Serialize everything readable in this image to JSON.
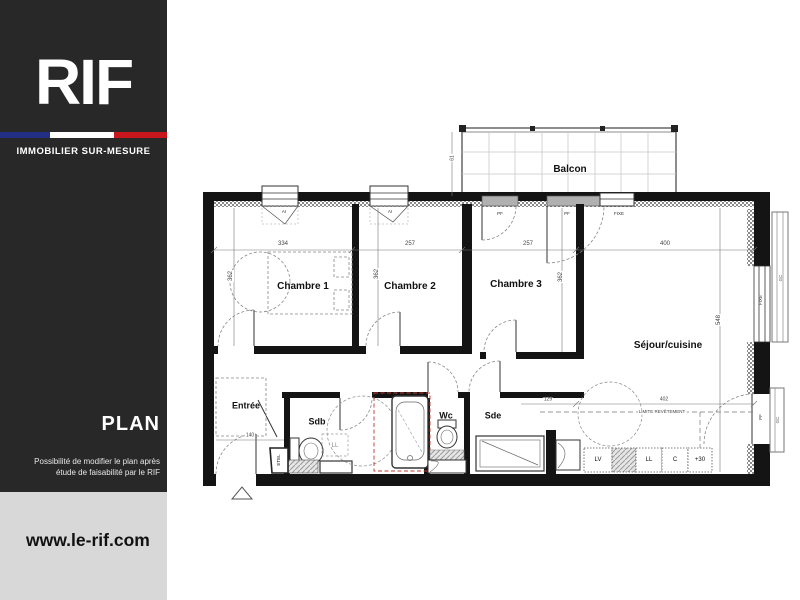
{
  "sidebar": {
    "brand": "RIF",
    "tagline": "IMMOBILIER  SUR-MESURE",
    "section_title": "PLAN",
    "note_line1": "Possibilité de modifier le plan après",
    "note_line2": "étude de faisabilité par le RIF",
    "website": "www.le-rif.com",
    "colors": {
      "sidebar_bg": "#282828",
      "flag_blue": "#232e85",
      "flag_white": "#ffffff",
      "flag_red": "#c8161d",
      "footer_bg": "#d8d8d8"
    }
  },
  "plan": {
    "labels": [
      {
        "id": "room-label-balcon",
        "text": "Balcon",
        "x": 570,
        "y": 170,
        "size": 10,
        "bold": true
      },
      {
        "id": "room-label-chambre-1",
        "text": "Chambre 1",
        "x": 303,
        "y": 287,
        "size": 10,
        "bold": true
      },
      {
        "id": "room-label-chambre-2",
        "text": "Chambre 2",
        "x": 410,
        "y": 287,
        "size": 10,
        "bold": true
      },
      {
        "id": "room-label-chambre-3",
        "text": "Chambre 3",
        "x": 516,
        "y": 285,
        "size": 10,
        "bold": true
      },
      {
        "id": "room-label-sejour-cuisine",
        "text": "Séjour/cuisine",
        "x": 668,
        "y": 346,
        "size": 10,
        "bold": true
      },
      {
        "id": "room-label-entree",
        "text": "Entrée",
        "x": 246,
        "y": 406,
        "size": 9,
        "bold": true
      },
      {
        "id": "room-label-sdb",
        "text": "Sdb",
        "x": 317,
        "y": 422,
        "size": 9,
        "bold": true
      },
      {
        "id": "room-label-wc",
        "text": "Wc",
        "x": 446,
        "y": 416,
        "size": 9,
        "bold": true
      },
      {
        "id": "room-label-sde",
        "text": "Sde",
        "x": 493,
        "y": 416,
        "size": 9,
        "bold": true
      },
      {
        "id": "dim-334",
        "text": "334",
        "x": 283,
        "y": 244,
        "size": 6,
        "bg": true,
        "color": "#444"
      },
      {
        "id": "dim-257-ch2",
        "text": "257",
        "x": 410,
        "y": 244,
        "size": 6,
        "bg": true,
        "color": "#444"
      },
      {
        "id": "dim-257-ch3",
        "text": "257",
        "x": 528,
        "y": 244,
        "size": 6,
        "bg": true,
        "color": "#444"
      },
      {
        "id": "dim-400",
        "text": "400",
        "x": 665,
        "y": 244,
        "size": 6,
        "bg": true,
        "color": "#444"
      },
      {
        "id": "dim-362-ch1",
        "text": "362",
        "x": 231,
        "y": 276,
        "size": 6,
        "rot": -90,
        "bg": true,
        "color": "#444"
      },
      {
        "id": "dim-362-ch2",
        "text": "362",
        "x": 377,
        "y": 274,
        "size": 6,
        "rot": -90,
        "bg": true,
        "color": "#444"
      },
      {
        "id": "dim-362-ch3",
        "text": "362",
        "x": 561,
        "y": 277,
        "size": 6,
        "rot": -90,
        "bg": true,
        "color": "#444"
      },
      {
        "id": "dim-548",
        "text": "548",
        "x": 719,
        "y": 320,
        "size": 6,
        "rot": -90,
        "bg": true,
        "color": "#444"
      },
      {
        "id": "dim-61",
        "text": "61",
        "x": 453,
        "y": 158,
        "size": 5,
        "rot": -90,
        "bg": true,
        "color": "#444"
      },
      {
        "id": "dim-140",
        "text": "140",
        "x": 250,
        "y": 436,
        "size": 5,
        "bg": true,
        "color": "#444"
      },
      {
        "id": "dim-129",
        "text": "129",
        "x": 548,
        "y": 400,
        "size": 5,
        "bg": true,
        "color": "#444"
      },
      {
        "id": "dim-402",
        "text": "402",
        "x": 664,
        "y": 400,
        "size": 5,
        "bg": true,
        "color": "#444"
      },
      {
        "id": "anno-limite-revetement",
        "text": "LIMITE REVÊTEMENT",
        "x": 662,
        "y": 412,
        "size": 4.5,
        "bg": true,
        "color": "#444"
      },
      {
        "id": "anno-lv",
        "text": "LV",
        "x": 598,
        "y": 460,
        "size": 6
      },
      {
        "id": "anno-ll-kitchen",
        "text": "LL",
        "x": 649,
        "y": 460,
        "size": 6
      },
      {
        "id": "anno-c",
        "text": "C",
        "x": 675,
        "y": 460,
        "size": 6
      },
      {
        "id": "anno-plus30",
        "text": "+30",
        "x": 700,
        "y": 460,
        "size": 6
      },
      {
        "id": "anno-ll-sdb",
        "text": "LL",
        "x": 335,
        "y": 446,
        "size": 6,
        "color": "#888"
      },
      {
        "id": "anno-etel",
        "text": "ETEL",
        "x": 279,
        "y": 460,
        "size": 4.5,
        "rot": -90
      },
      {
        "id": "anno-ai-window-1",
        "text": "AI",
        "x": 284,
        "y": 212,
        "size": 4.5,
        "color": "#333"
      },
      {
        "id": "anno-ai-window-2",
        "text": "AI",
        "x": 390,
        "y": 212,
        "size": 4.5,
        "color": "#333"
      },
      {
        "id": "anno-pf-ch3",
        "text": "PF",
        "x": 500,
        "y": 214,
        "size": 4.5,
        "color": "#333"
      },
      {
        "id": "anno-pf-sejour",
        "text": "PF",
        "x": 567,
        "y": 214,
        "size": 4.5,
        "color": "#333"
      },
      {
        "id": "anno-fixe",
        "text": "FIXE",
        "x": 619,
        "y": 214,
        "size": 4.5,
        "color": "#333"
      },
      {
        "id": "anno-fixe-right",
        "text": "FIXE",
        "x": 761,
        "y": 300,
        "size": 4.5,
        "rot": -90,
        "color": "#333"
      },
      {
        "id": "anno-pf-right",
        "text": "PF",
        "x": 761,
        "y": 417,
        "size": 4.5,
        "rot": -90,
        "color": "#333"
      },
      {
        "id": "anno-gc-rail-1",
        "text": "GC",
        "x": 781,
        "y": 278,
        "size": 4.5,
        "rot": -90,
        "color": "#555"
      },
      {
        "id": "anno-gc-rail-2",
        "text": "GC",
        "x": 778,
        "y": 420,
        "size": 4.5,
        "rot": -90,
        "color": "#555"
      }
    ]
  }
}
